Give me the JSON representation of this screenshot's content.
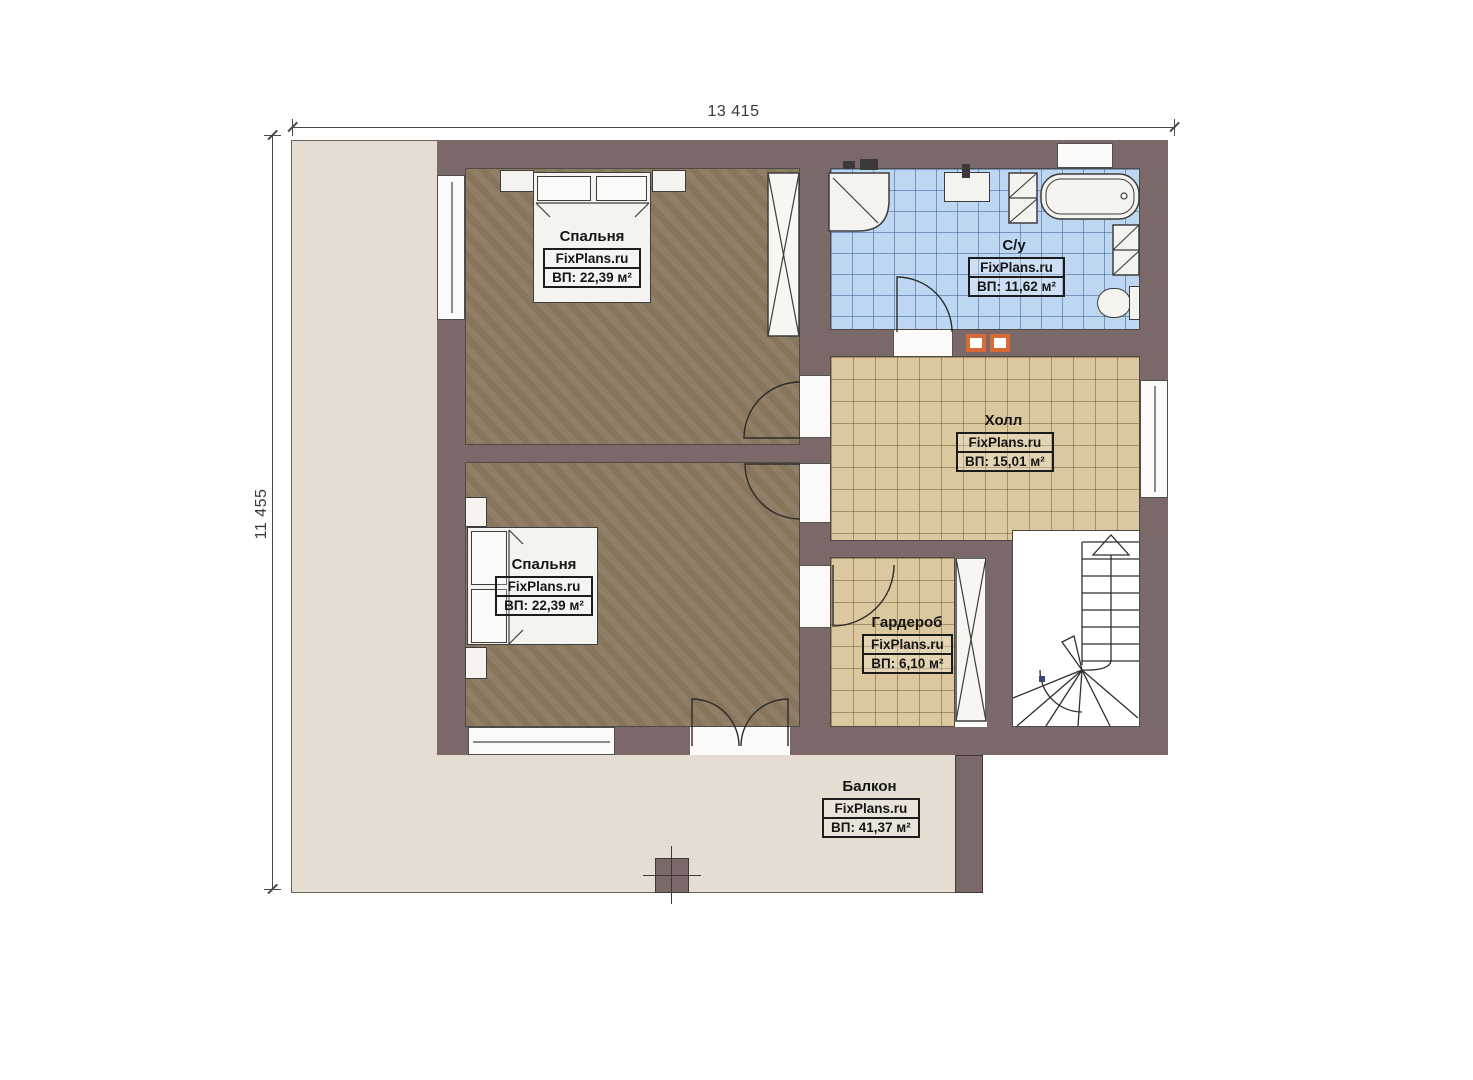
{
  "plan": {
    "type": "floor-plan",
    "floor_description": "second floor apartment plan"
  },
  "dimensions": {
    "width_label": "13 415",
    "height_label": "11 455"
  },
  "rooms": {
    "bedroom_top": {
      "name": "Спальня",
      "brand": "FixPlans.ru",
      "area": "ВП: 22,39 м²"
    },
    "bathroom": {
      "name": "С/у",
      "brand": "FixPlans.ru",
      "area": "ВП: 11,62 м²"
    },
    "hall": {
      "name": "Холл",
      "brand": "FixPlans.ru",
      "area": "ВП: 15,01 м²"
    },
    "bedroom_bottom": {
      "name": "Спальня",
      "brand": "FixPlans.ru",
      "area": "ВП: 22,39 м²"
    },
    "wardrobe": {
      "name": "Гардероб",
      "brand": "FixPlans.ru",
      "area": "ВП: 6,10 м²"
    },
    "balcony": {
      "name": "Балкон",
      "brand": "FixPlans.ru",
      "area": "ВП: 41,37 м²"
    }
  },
  "colors": {
    "wall": "#7b696a",
    "bedroom_floor": "#8c7a60",
    "bathroom_floor": "#bdd7f3",
    "hall_floor": "#dbc89e",
    "terrace": "#e5ddd1",
    "fixture_white": "#f4f3f0",
    "accent_orange": "#d96a35"
  }
}
